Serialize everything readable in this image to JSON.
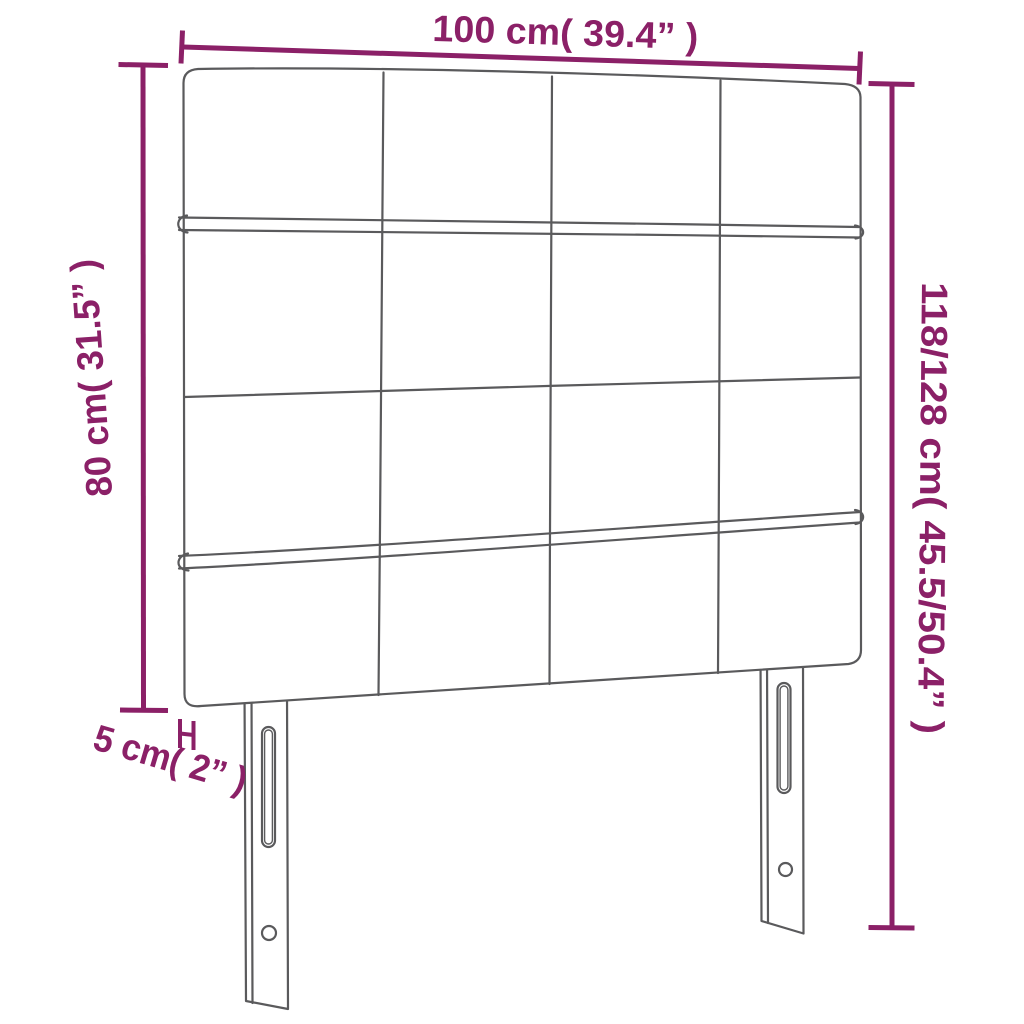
{
  "diagram": {
    "title": "Headboard dimension diagram",
    "product": "Upholstered headboard with 4x4 tufted square panels and two slotted mounting legs",
    "dimensions": {
      "width_label": "100 cm( 39.4” )",
      "panel_height_label": "80 cm( 31.5” )",
      "total_height_label": "118/128 cm( 45.5/50.4” )",
      "thickness_label": "5 cm( 2” )"
    },
    "grid": {
      "rows": 4,
      "columns": 4
    },
    "legs": {
      "count": 2,
      "features": [
        "vertical adjustment slot",
        "round bolt hole"
      ]
    },
    "colors": {
      "dimension_annotation": "#8b2067",
      "line_art": "#5a5a5c",
      "background": "#ffffff"
    }
  }
}
